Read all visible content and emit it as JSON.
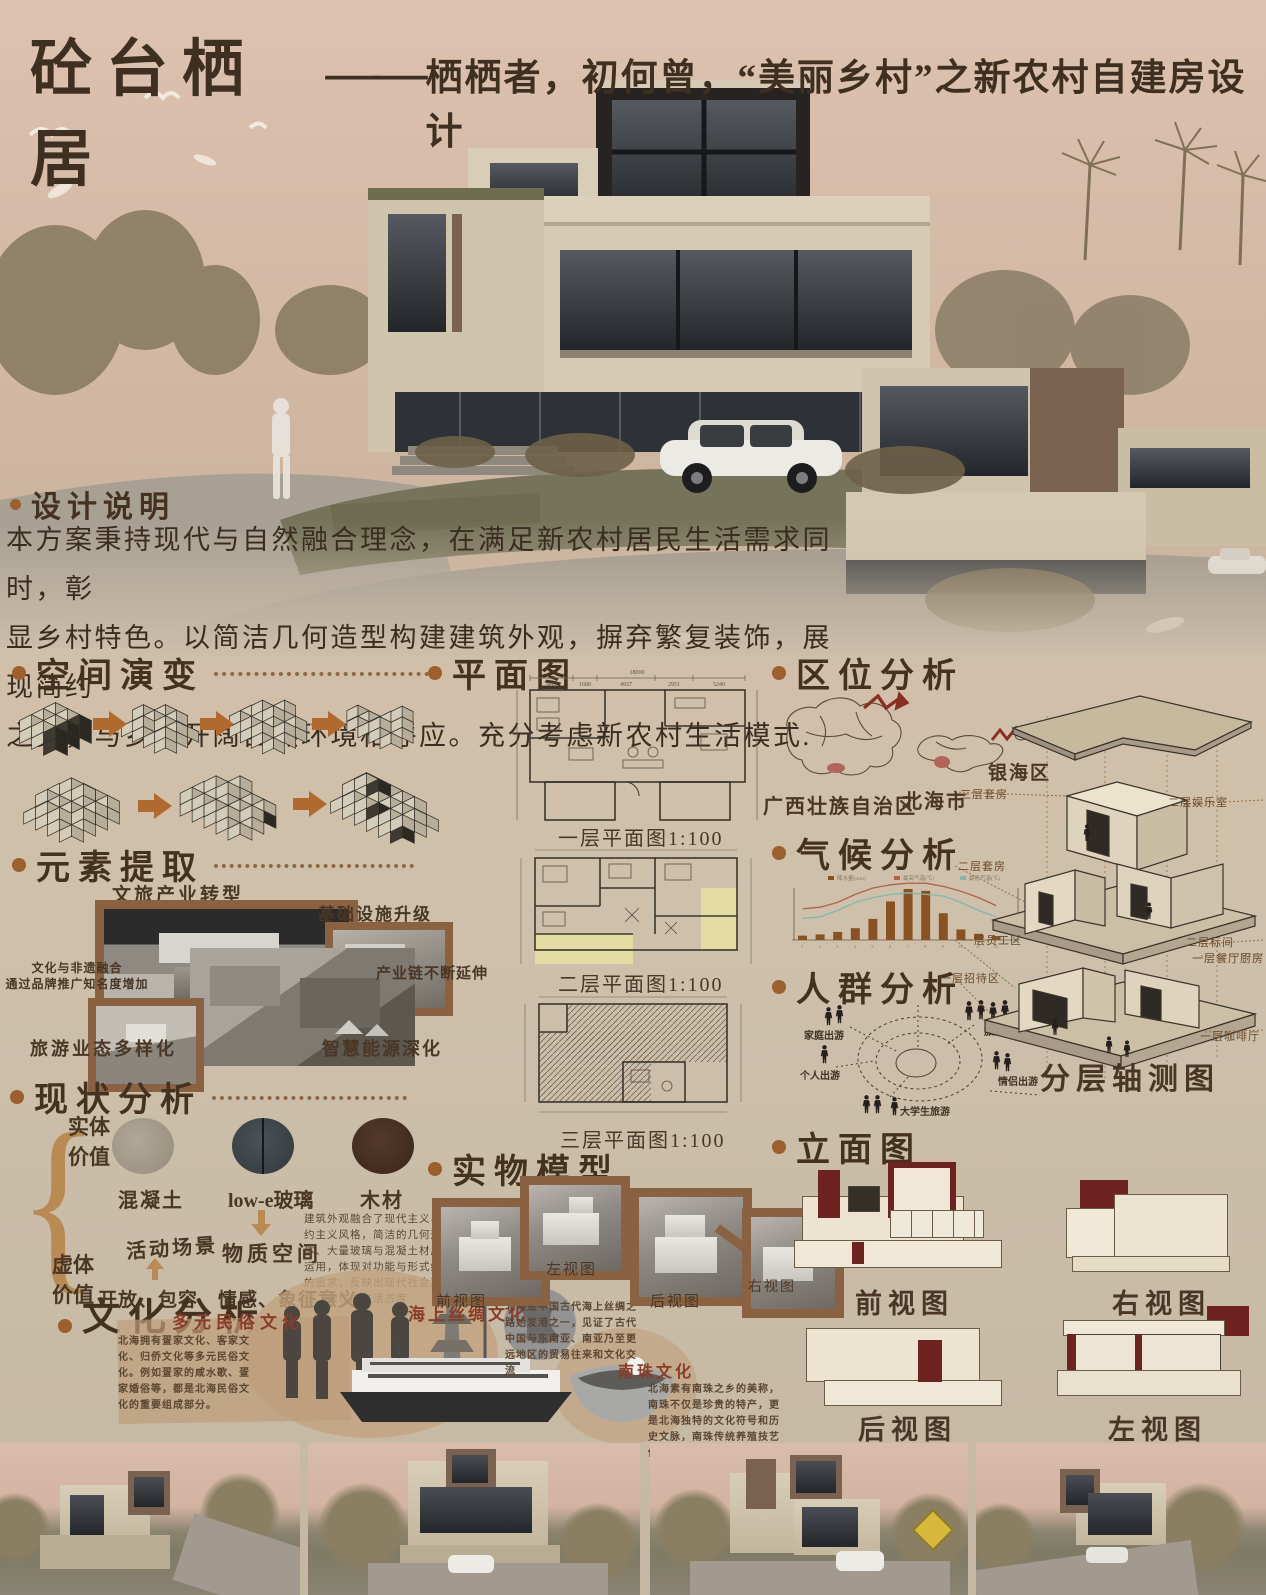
{
  "poster": {
    "title": "砼台栖居",
    "dash": "——",
    "subtitle": "栖栖者，初何曾，“美丽乡村”之新农村自建房设计"
  },
  "design_note": {
    "heading": "设计说明",
    "l1": "本方案秉持现代与自然融合理念，在满足新农村居民生活需求同时，彰",
    "l2": "显乡村特色。以简洁几何造型构建建筑外观，摒弃繁复装饰，展现简约",
    "l3": "之美，与乡村开阔自然环境相呼应。充分考虑新农村生活模式."
  },
  "space_evolution": {
    "heading": "空间演变"
  },
  "elements": {
    "heading": "元素提取",
    "top_label": "文旅产业转型",
    "upgrade_label": "基础设施升级",
    "fusion_note": "文化与非遗融合\n通过品牌推广知名度增加",
    "chain_label": "产业链不断延伸",
    "tourism_label": "旅游业态多样化",
    "energy_label": "智慧能源深化"
  },
  "status": {
    "heading": "现状分析",
    "solid_label": "实体价值",
    "void_label": "虚体价值",
    "materials": [
      "混凝土",
      "low-e玻璃",
      "木材"
    ],
    "material_space": "物质空间",
    "activity": "活动场景",
    "void_values": "开放、包容、情感、象征意义",
    "paragraph": "建筑外观融合了现代主义与简约主义风格，简洁的几何形体、大量玻璃与混凝土材质的运用，体现对功能与形式统一的追求，反映出现代社会高效、理性的生活态度"
  },
  "culture": {
    "heading": "文化分析",
    "items": [
      {
        "title": "多元民俗文化",
        "text": "北海拥有疍家文化、客家文化、归侨文化等多元民俗文化。例如疍家的咸水歌、疍家婚俗等，都是北海民俗文化的重要组成部分。"
      },
      {
        "title": "海上丝绸文化",
        "text": "北海是中国古代海上丝绸之路始发港之一，见证了古代中国与东南亚、南亚乃至更远地区的贸易往来和文化交流"
      },
      {
        "title": "南珠文化",
        "text": "北海素有南珠之乡的美称，南珠不仅是珍贵的特产，更是北海独特的文化符号和历史文脉，南珠传统养殖技艺传承至今。"
      }
    ]
  },
  "floor_plans": {
    "heading": "平面图",
    "plans": [
      {
        "label": "一层平面图1:100",
        "total_dim": "18000",
        "top_dims": [
          "3412",
          "1680",
          "4937",
          "2951",
          "5249"
        ]
      },
      {
        "label": "二层平面图1:100"
      },
      {
        "label": "三层平面图1:100"
      }
    ]
  },
  "model": {
    "heading": "实物模型",
    "views": [
      "前视图",
      "左视图",
      "后视图",
      "右视图"
    ]
  },
  "location": {
    "heading": "区位分析",
    "labels": [
      "广西壮族自治区",
      "北海市",
      "银海区"
    ]
  },
  "climate": {
    "heading": "气候分析"
  },
  "crowd": {
    "heading": "人群分析",
    "groups": [
      "家庭出游",
      "个人出游",
      "大学生旅游",
      "旅游团",
      "情侣出游"
    ]
  },
  "axon": {
    "caption": "分层轴测图",
    "left_labels": [
      "三层套房",
      "二层套房",
      "一层员工区",
      "一层招待区"
    ],
    "right_labels": [
      "二层娱乐室",
      "二层标间",
      "一层餐厅厨房",
      "一层咖啡厅"
    ]
  },
  "elevations": {
    "heading": "立面图",
    "views": [
      "前视图",
      "右视图",
      "后视图",
      "左视图"
    ]
  },
  "colors": {
    "accent_brown": "#9c5f2e",
    "deep_red": "#6e2320",
    "frame_brown": "#8a6242",
    "paper": "#cec0ab"
  },
  "chart_data": {
    "type": "bar",
    "title": "",
    "categories": [
      "1",
      "2",
      "3",
      "4",
      "5",
      "6",
      "7",
      "8",
      "9",
      "10",
      "11",
      "12"
    ],
    "series": [
      {
        "name": "降水量(mm)",
        "kind": "bar",
        "values": [
          35,
          45,
          65,
          95,
          170,
          310,
          410,
          395,
          215,
          85,
          50,
          32
        ]
      },
      {
        "name": "最高气温(℃)",
        "kind": "line",
        "values": [
          17,
          18,
          21,
          26,
          30,
          32,
          33,
          33,
          31,
          28,
          24,
          19
        ]
      },
      {
        "name": "最低气温(℃)",
        "kind": "line",
        "values": [
          11,
          12,
          16,
          21,
          24,
          26,
          27,
          26,
          25,
          21,
          16,
          12
        ]
      }
    ],
    "ylim_bar": [
      0,
      450
    ],
    "ylim_line": [
      0,
      35
    ],
    "legend_position": "top",
    "grid": false
  }
}
